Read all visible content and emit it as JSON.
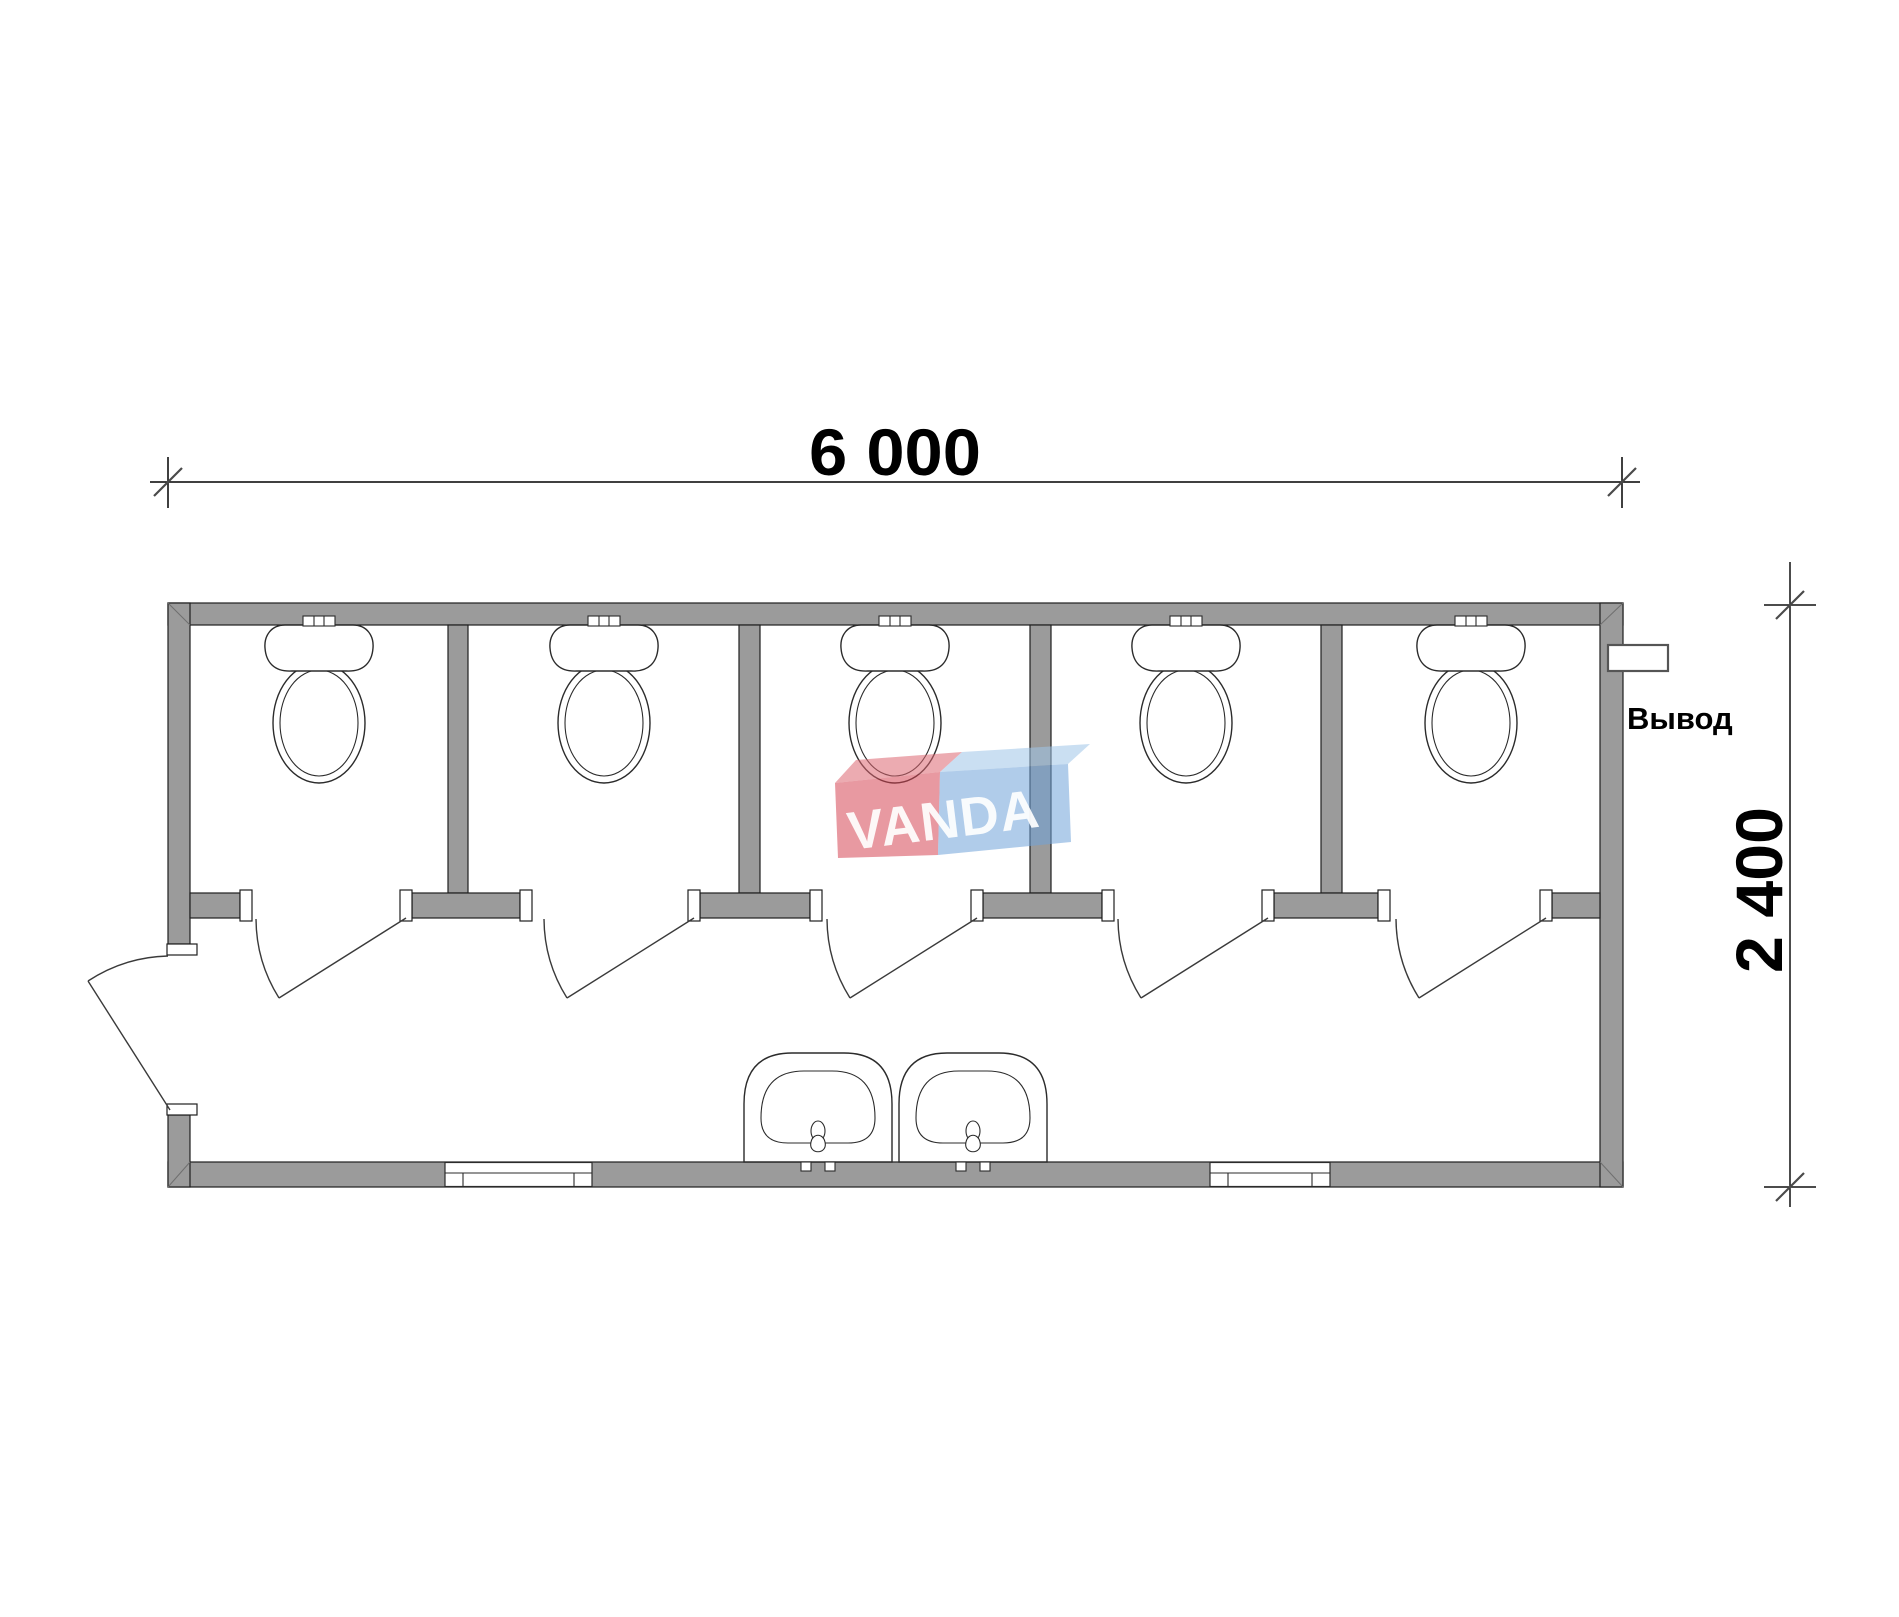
{
  "dimensions": {
    "width_label": "6 000",
    "depth_label": "2 400"
  },
  "labels": {
    "outlet": "Вывод"
  },
  "watermark": {
    "text": "VANDA",
    "red_front": "#d64653",
    "red_top": "#dd6671",
    "blue_front": "#6fa3d8",
    "blue_top": "#9ec4e8"
  },
  "colors": {
    "wall_fill": "#9b9b9b",
    "wall_outline": "#1f1f1f",
    "fixture_line": "#2b2b2b",
    "dimension_line": "#000000"
  },
  "fixtures": {
    "toilet_stalls": 5,
    "toilets": 5,
    "sinks": 2,
    "stall_doors": 5,
    "entrance_doors": 1,
    "windows": 2,
    "outlets": 1
  }
}
